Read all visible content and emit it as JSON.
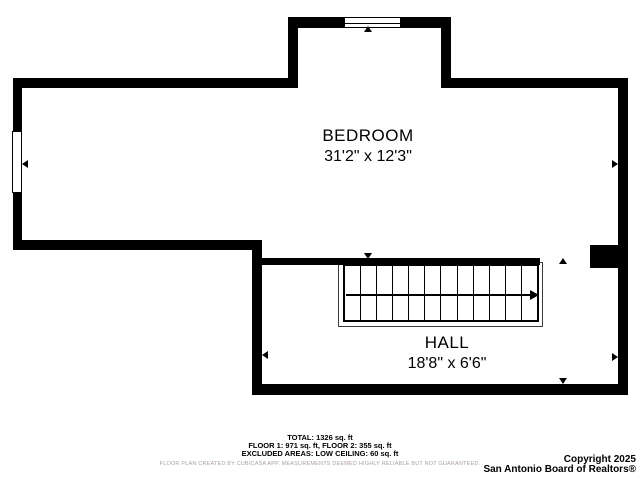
{
  "floorplan": {
    "rooms": [
      {
        "name": "BEDROOM",
        "dimensions": "31'2\" x 12'3\""
      },
      {
        "name": "HALL",
        "dimensions": "18'8\" x 6'6\""
      }
    ],
    "stairs": {
      "treads": 12,
      "direction": "right"
    },
    "windows": 2
  },
  "summary": {
    "total": "TOTAL: 1326 sq. ft",
    "floors": "FLOOR 1: 971 sq. ft, FLOOR 2: 355 sq. ft",
    "excluded": "EXCLUDED AREAS: LOW CEILING: 60 sq. ft"
  },
  "disclaimer": "FLOOR PLAN CREATED BY CUBICASA APP. MEASUREMENTS DEEMED HIGHLY RELIABLE BUT NOT GUARANTEED.",
  "copyright": {
    "line1": "Copyright 2025",
    "line2": "San Antonio Board of Realtors®"
  },
  "colors": {
    "wall": "#000000",
    "background": "#ffffff",
    "disclaimer_text": "#ab9f9a"
  }
}
